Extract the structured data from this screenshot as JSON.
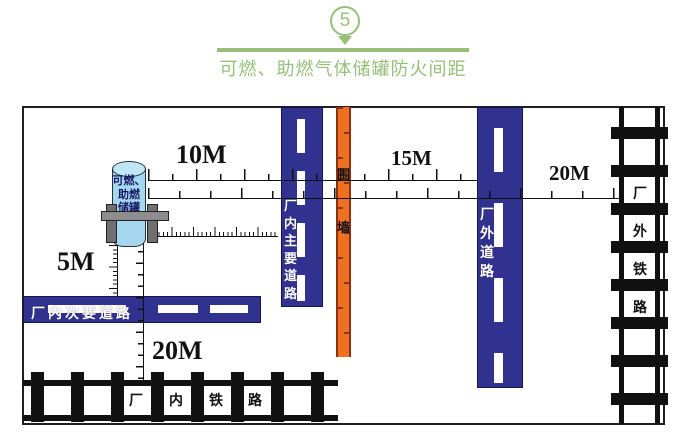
{
  "header": {
    "badge_number": "5",
    "title": "可燃、助燃气体储罐防火间距"
  },
  "tank": {
    "lines": [
      "可燃、",
      "助燃",
      "储罐"
    ]
  },
  "labels": {
    "road_secondary": "厂内次要道路",
    "road_main_chars": [
      "厂",
      "内",
      "主",
      "要",
      "道",
      "路"
    ],
    "road_outer_chars": [
      "厂",
      "外",
      "道",
      "路"
    ],
    "wall_chars": [
      "围",
      "墙"
    ],
    "rail_outer_chars": [
      "厂",
      "外",
      "铁",
      "路"
    ],
    "rail_inner_chars": [
      "厂",
      "内",
      "铁",
      "路"
    ]
  },
  "measurements": {
    "tank_to_main_road": "10M",
    "wall_to_outer_road": "15M",
    "to_outer_rail": "20M",
    "tank_to_secondary_road": "5M",
    "to_inner_rail": "20M"
  },
  "colors": {
    "accent_green": "#98bf7a",
    "road_blue": "#31318f",
    "wall_orange": "#ee7023",
    "tank_blue": "#a5d8ee"
  }
}
